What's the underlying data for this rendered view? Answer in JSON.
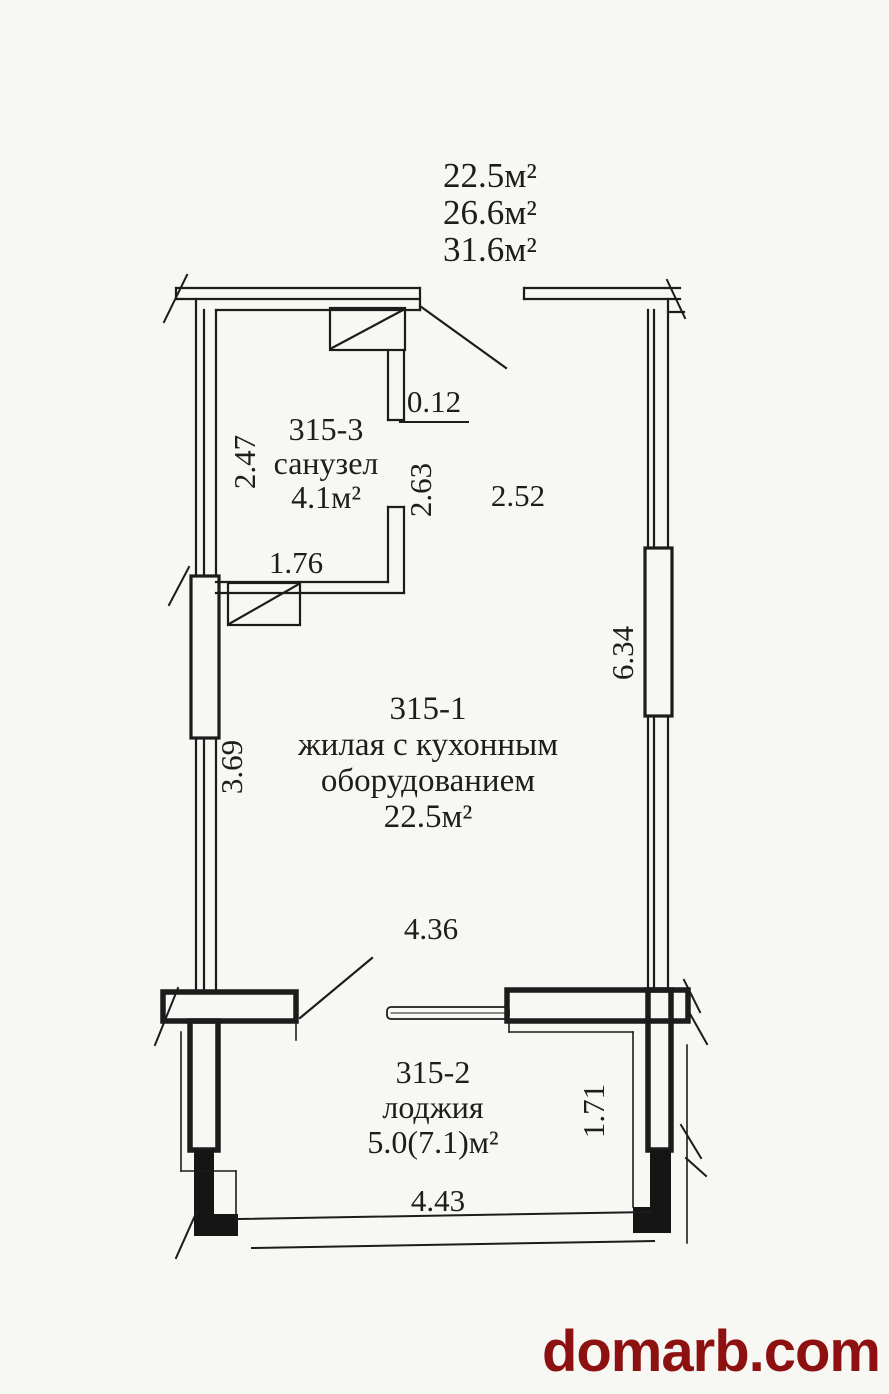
{
  "page": {
    "paper_color": "#f7f7f4",
    "ink_color": "#1c1c1c"
  },
  "area_summary": {
    "line1": "22.5м²",
    "line2": "26.6м²",
    "line3": "31.6м²"
  },
  "rooms": {
    "bathroom": {
      "id": "315-3",
      "name": "санузел",
      "area": "4.1м²"
    },
    "living": {
      "id": "315-1",
      "name_line1": "жилая с кухонным",
      "name_line2": "оборудованием",
      "area": "22.5м²"
    },
    "loggia": {
      "id": "315-2",
      "name": "лоджия",
      "area": "5.0(7.1)м²"
    }
  },
  "dimensions": {
    "duct_offset": "0.12",
    "bathroom_width": "2.47",
    "bathroom_height": "2.63",
    "entry_width": "2.52",
    "bathroom_door_wall": "1.76",
    "living_right_wall": "6.34",
    "living_left_wall": "3.69",
    "living_width": "4.36",
    "loggia_depth": "1.71",
    "loggia_width": "4.43"
  },
  "watermark": {
    "text": "domarb.com",
    "color": "#8e1111"
  }
}
